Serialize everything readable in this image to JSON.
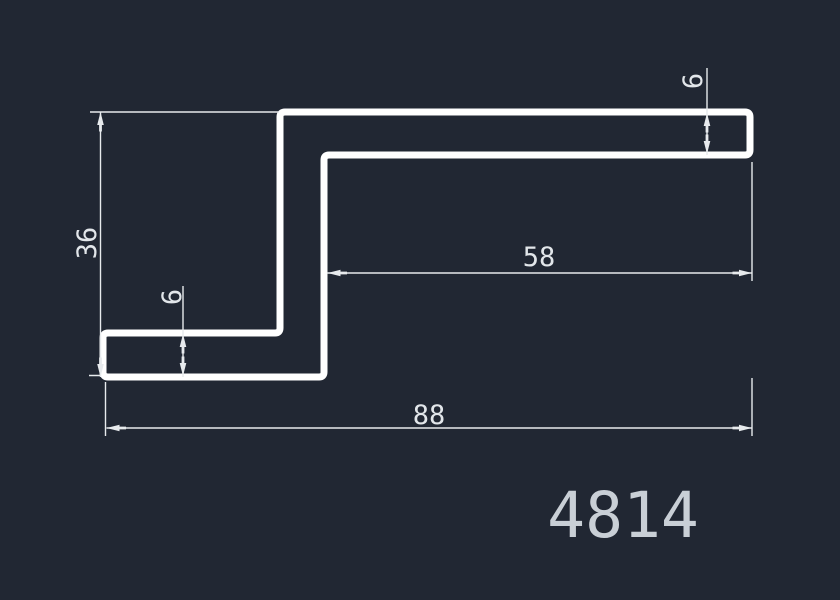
{
  "drawing": {
    "background_color": "#212733",
    "profile_color": "#ffffff",
    "dim_line_color": "#e7eaed",
    "dim_text_color": "#e2e6ea",
    "part_label_color": "#c9cfd6",
    "part_label": {
      "text": "4814",
      "transform": "translate(623,537)"
    },
    "profile": {
      "name": "z-step-profile-cross-section",
      "stroke_width": 7,
      "path": "M 200 377 H 108 Q 103 377 103 372 V 338 Q 103 333 108 333 H 275 Q 280 333 280 328 V 117 Q 280 112 285 112 H 745 Q 750 112 750 117 V 150 Q 750 155 745 155 H 329 Q 324 155 324 160 V 372 Q 324 377 319 377 Z"
    },
    "dims": {
      "d36": {
        "value": "36",
        "lines": "M 100.5 112 V 377 M 90 112 H 279 M 89 375.5 H 101",
        "arrows": "M 100.5 112 L 97.2 125 H 103.8 Z M 99.1 125 h 2.8 v 6.5 h -2.8 Z M 100.5 377 L 97.2 364 H 103.8 Z M 99.1 357.5 h 2.8 v 6.5 h -2.8 Z",
        "text_transform": "translate(96,243) rotate(-90)"
      },
      "d6_left": {
        "value": "6",
        "lines": "M 183 286 V 377",
        "arrows": "M 183 334 L 179.7 347 H 186.3 Z M 181.6 347 h 2.8 v 6.5 h -2.8 Z M 183 376 L 179.7 363 H 186.3 Z M 181.6 356.5 h 2.8 v 6.5 h -2.8 Z",
        "text_transform": "translate(181,297) rotate(-90)"
      },
      "d6_top": {
        "value": "6",
        "lines": "M 707 68 V 155",
        "arrows": "M 707 113 L 703.7 126 H 710.3 Z M 705.6 126 h 2.8 v 6.5 h -2.8 Z M 707 154 L 703.7 141 H 710.3 Z M 705.6 134.5 h 2.8 v 6.5 h -2.8 Z",
        "text_transform": "translate(702,81) rotate(-90)"
      },
      "d58": {
        "value": "58",
        "lines": "M 327 273 H 752 M 752 162 V 281",
        "arrows": "M 327.5 273 L 340.5 269.7 V 276.3 Z M 340.5 271.6 h 6.5 v 2.8 h -6.5 Z M 752 273 L 739 269.7 V 276.3 Z M 732.5 271.6 h 6.5 v 2.8 h -6.5 Z",
        "text_transform": "translate(539,266)"
      },
      "d88": {
        "value": "88",
        "lines": "M 106.5 428 H 752 M 105.5 382 V 436 M 752 378 V 436",
        "arrows": "M 106.5 428 L 119.5 424.7 V 431.3 Z M 119.5 426.6 h 6.5 v 2.8 h -6.5 Z M 752 428 L 739 424.7 V 431.3 Z M 732.5 426.6 h 6.5 v 2.8 h -6.5 Z",
        "text_transform": "translate(429,424)"
      }
    }
  }
}
